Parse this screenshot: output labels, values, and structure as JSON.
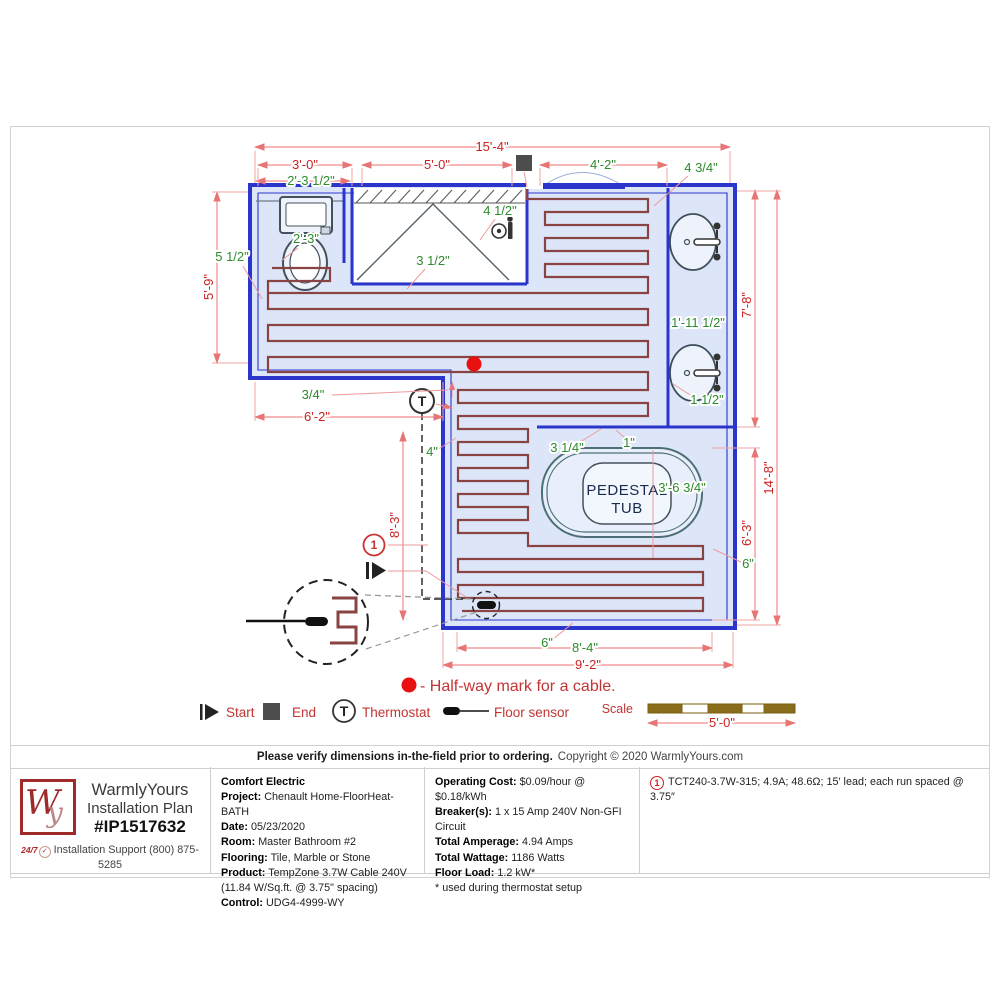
{
  "plan": {
    "tub": {
      "line1": "PEDESTAL",
      "line2": "TUB"
    },
    "thermostat_symbol": "T",
    "cable_number": "1",
    "halfway_note": "- Half-way mark for a cable.",
    "legend": {
      "start": "Start",
      "end": "End",
      "thermostat": "Thermostat",
      "floor_sensor": "Floor sensor"
    },
    "scale_label": "Scale",
    "dimensions": [
      {
        "t": "15'-4\"",
        "x": 492,
        "y": 151,
        "c": "red"
      },
      {
        "t": "3'-0\"",
        "x": 305,
        "y": 169,
        "c": "red"
      },
      {
        "t": "5'-0\"",
        "x": 437,
        "y": 169,
        "c": "red"
      },
      {
        "t": "4'-2\"",
        "x": 603,
        "y": 169,
        "c": "green"
      },
      {
        "t": "4 3/4\"",
        "x": 701,
        "y": 172,
        "c": "green"
      },
      {
        "t": "2'-3 1/2\"",
        "x": 311,
        "y": 185,
        "c": "green"
      },
      {
        "t": "2'-3\"",
        "x": 306,
        "y": 243,
        "c": "green"
      },
      {
        "t": "4 1/2\"",
        "x": 500,
        "y": 215,
        "c": "green"
      },
      {
        "t": "3 1/2\"",
        "x": 433,
        "y": 265,
        "c": "green"
      },
      {
        "t": "5 1/2\"",
        "x": 232,
        "y": 261,
        "c": "green"
      },
      {
        "t": "5'-9\"",
        "x": 213,
        "y": 287,
        "c": "red",
        "rot": -90
      },
      {
        "t": "3/4\"",
        "x": 313,
        "y": 399,
        "c": "green"
      },
      {
        "t": "6'-2\"",
        "x": 317,
        "y": 421,
        "c": "red"
      },
      {
        "t": "8'-3\"",
        "x": 399,
        "y": 525,
        "c": "red",
        "rot": -90
      },
      {
        "t": "4\"",
        "x": 432,
        "y": 456,
        "c": "green"
      },
      {
        "t": "1'-11 1/2\"",
        "x": 698,
        "y": 327,
        "c": "green"
      },
      {
        "t": "1 1/2\"",
        "x": 707,
        "y": 404,
        "c": "green"
      },
      {
        "t": "7'-8\"",
        "x": 751,
        "y": 305,
        "c": "red",
        "rot": -90
      },
      {
        "t": "14'-8\"",
        "x": 773,
        "y": 478,
        "c": "red",
        "rot": -90
      },
      {
        "t": "6'-3\"",
        "x": 751,
        "y": 533,
        "c": "red",
        "rot": -90
      },
      {
        "t": "3 1/4\"",
        "x": 567,
        "y": 452,
        "c": "green"
      },
      {
        "t": "1\"",
        "x": 629,
        "y": 447,
        "c": "green"
      },
      {
        "t": "3'-6 3/4\"",
        "x": 682,
        "y": 492,
        "c": "green"
      },
      {
        "t": "6\"",
        "x": 748,
        "y": 568,
        "c": "green"
      },
      {
        "t": "6\"",
        "x": 547,
        "y": 647,
        "c": "green"
      },
      {
        "t": "8'-4\"",
        "x": 585,
        "y": 652,
        "c": "green"
      },
      {
        "t": "9'-2\"",
        "x": 588,
        "y": 669,
        "c": "red"
      },
      {
        "t": "5'-0\"",
        "x": 722,
        "y": 727,
        "c": "red"
      }
    ],
    "colors": {
      "wall_blue": "#2b35cc",
      "floor_fill": "#dce6f8",
      "cable": "#8a4343",
      "dim_red": "#cc2222",
      "dim_green": "#2e8b2e",
      "dim_line_pink": "#ef8a8a",
      "marker_red": "#e81010",
      "scale_brown": "#8a6d1a",
      "logo_red": "#9e2a2a"
    }
  },
  "footer": {
    "notice_bold": "Please verify dimensions in-the-field prior to ordering.",
    "notice_rest": "Copyright © 2020 WarmlyYours.com"
  },
  "brand": {
    "logo_w": "W",
    "logo_y": "y",
    "line1": "WarmlyYours",
    "line2": "Installation Plan",
    "plan_number": "#IP1517632",
    "support_badge": "24/7",
    "support_check": "✓",
    "support_line1": "Installation Support (800) 875-",
    "support_line2": "5285"
  },
  "project": {
    "company": "Comfort Electric",
    "rows": [
      {
        "label": "Project:",
        "value": "Chenault Home-FloorHeat-BATH"
      },
      {
        "label": "Date:",
        "value": "05/23/2020"
      },
      {
        "label": "Room:",
        "value": "Master Bathroom #2"
      },
      {
        "label": "Flooring:",
        "value": "Tile, Marble or Stone"
      },
      {
        "label": "Product:",
        "value": "TempZone 3.7W Cable 240V (11.84 W/Sq.ft. @ 3.75\" spacing)"
      },
      {
        "label": "Control:",
        "value": "UDG4-4999-WY"
      }
    ]
  },
  "electrical": {
    "rows": [
      {
        "label": "Operating Cost:",
        "value": "$0.09/hour @ $0.18/kWh"
      },
      {
        "label": "Breaker(s):",
        "value": "1 x 15 Amp 240V Non-GFI Circuit"
      },
      {
        "label": "Total Amperage:",
        "value": "4.94 Amps"
      },
      {
        "label": "Total Wattage:",
        "value": "1186 Watts"
      },
      {
        "label": "Floor Load:",
        "value": "1.2 kW*"
      }
    ],
    "note": "* used during thermostat setup"
  },
  "cable_spec": {
    "number": "1",
    "text": "TCT240-3.7W-315; 4.9A; 48.6Ω; 15′ lead; each run spaced @ 3.75″"
  }
}
